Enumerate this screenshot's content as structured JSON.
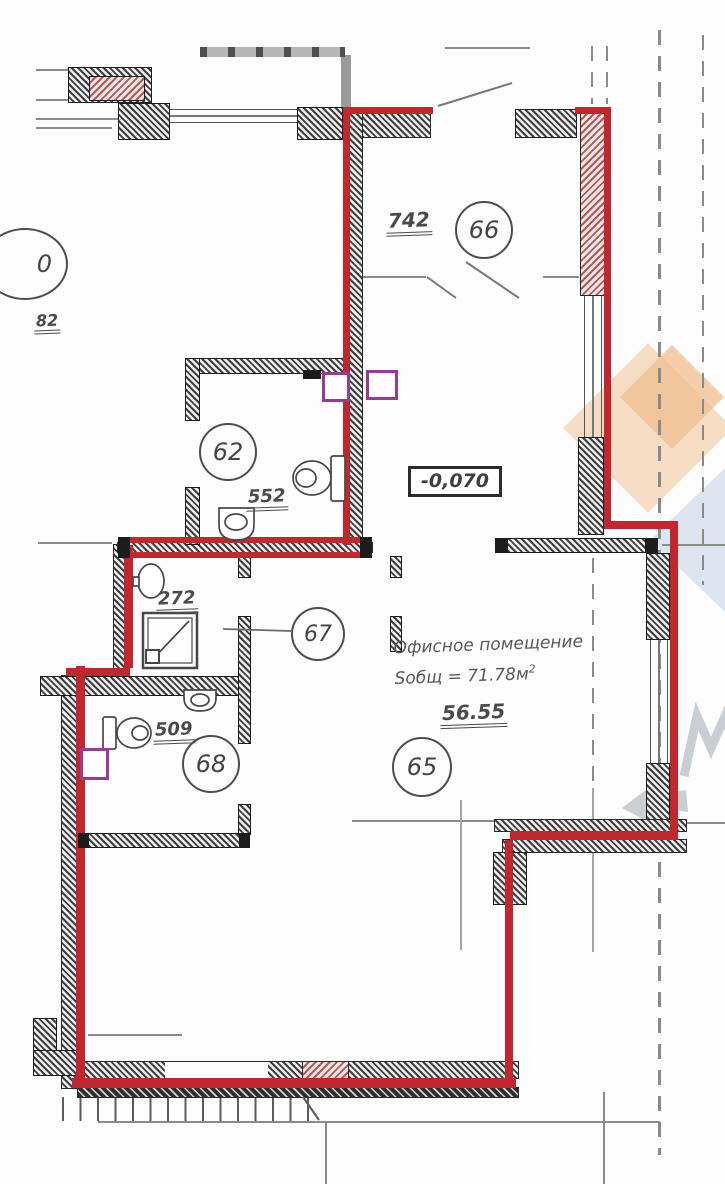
{
  "unit": {
    "type_label": "Офисное помещение",
    "area_label": "Sобщ = 71.78м",
    "area_sup": "2",
    "elevation": "-0,070"
  },
  "rooms": [
    {
      "number": "62",
      "dim": "552"
    },
    {
      "number": "66",
      "dim": "742"
    },
    {
      "number": "67",
      "dim": "272"
    },
    {
      "number": "68",
      "dim": "509"
    },
    {
      "number": "65",
      "dim": "56.55"
    },
    {
      "number": "0",
      "dim": "82"
    }
  ],
  "colors": {
    "outline_red": "#c1272d",
    "vent_purple": "#993a99",
    "wall_ink": "#1c1c1c",
    "watermark_orange": "#f6dcc3",
    "watermark_blue": "#dce4ef"
  }
}
